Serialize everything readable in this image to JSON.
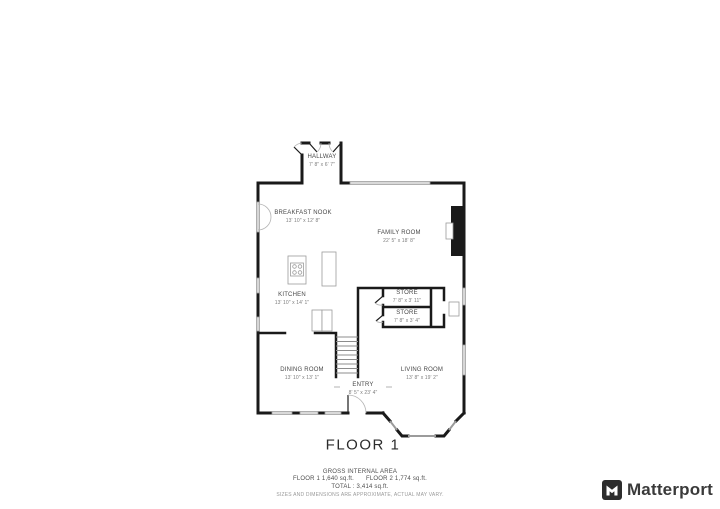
{
  "floor_plan": {
    "title": "FLOOR 1",
    "rooms": [
      {
        "name": "HALLWAY",
        "dims": "7' 8\" x 6' 7\""
      },
      {
        "name": "BREAKFAST NOOK",
        "dims": "13' 10\" x 12' 8\""
      },
      {
        "name": "FAMILY ROOM",
        "dims": "22' 5\" x 18' 8\""
      },
      {
        "name": "KITCHEN",
        "dims": "13' 10\" x 14' 1\""
      },
      {
        "name": "STORE",
        "dims": "7' 8\" x 3' 11\""
      },
      {
        "name": "STORE",
        "dims": "7' 8\" x 3' 4\""
      },
      {
        "name": "DINING ROOM",
        "dims": "13' 10\" x 13' 1\""
      },
      {
        "name": "ENTRY",
        "dims": "8' 5\" x 23' 4\""
      },
      {
        "name": "LIVING ROOM",
        "dims": "13' 8\" x 19' 2\""
      }
    ]
  },
  "footer": {
    "heading": "GROSS INTERNAL AREA",
    "floor1": "FLOOR 1 1,640 sq.ft.",
    "floor2": "FLOOR 2 1,774 sq.ft.",
    "total": "TOTAL :  3,414 sq.ft.",
    "disclaimer": "SIZES AND DIMENSIONS ARE APPROXIMATE, ACTUAL MAY VARY."
  },
  "brand": {
    "name": "Matterport"
  },
  "colors": {
    "wall": "#1a1a1a",
    "window": "#9b9b9b",
    "label": "#474747",
    "dims": "#7d7d7d",
    "brand_text": "#3a3a3a"
  }
}
